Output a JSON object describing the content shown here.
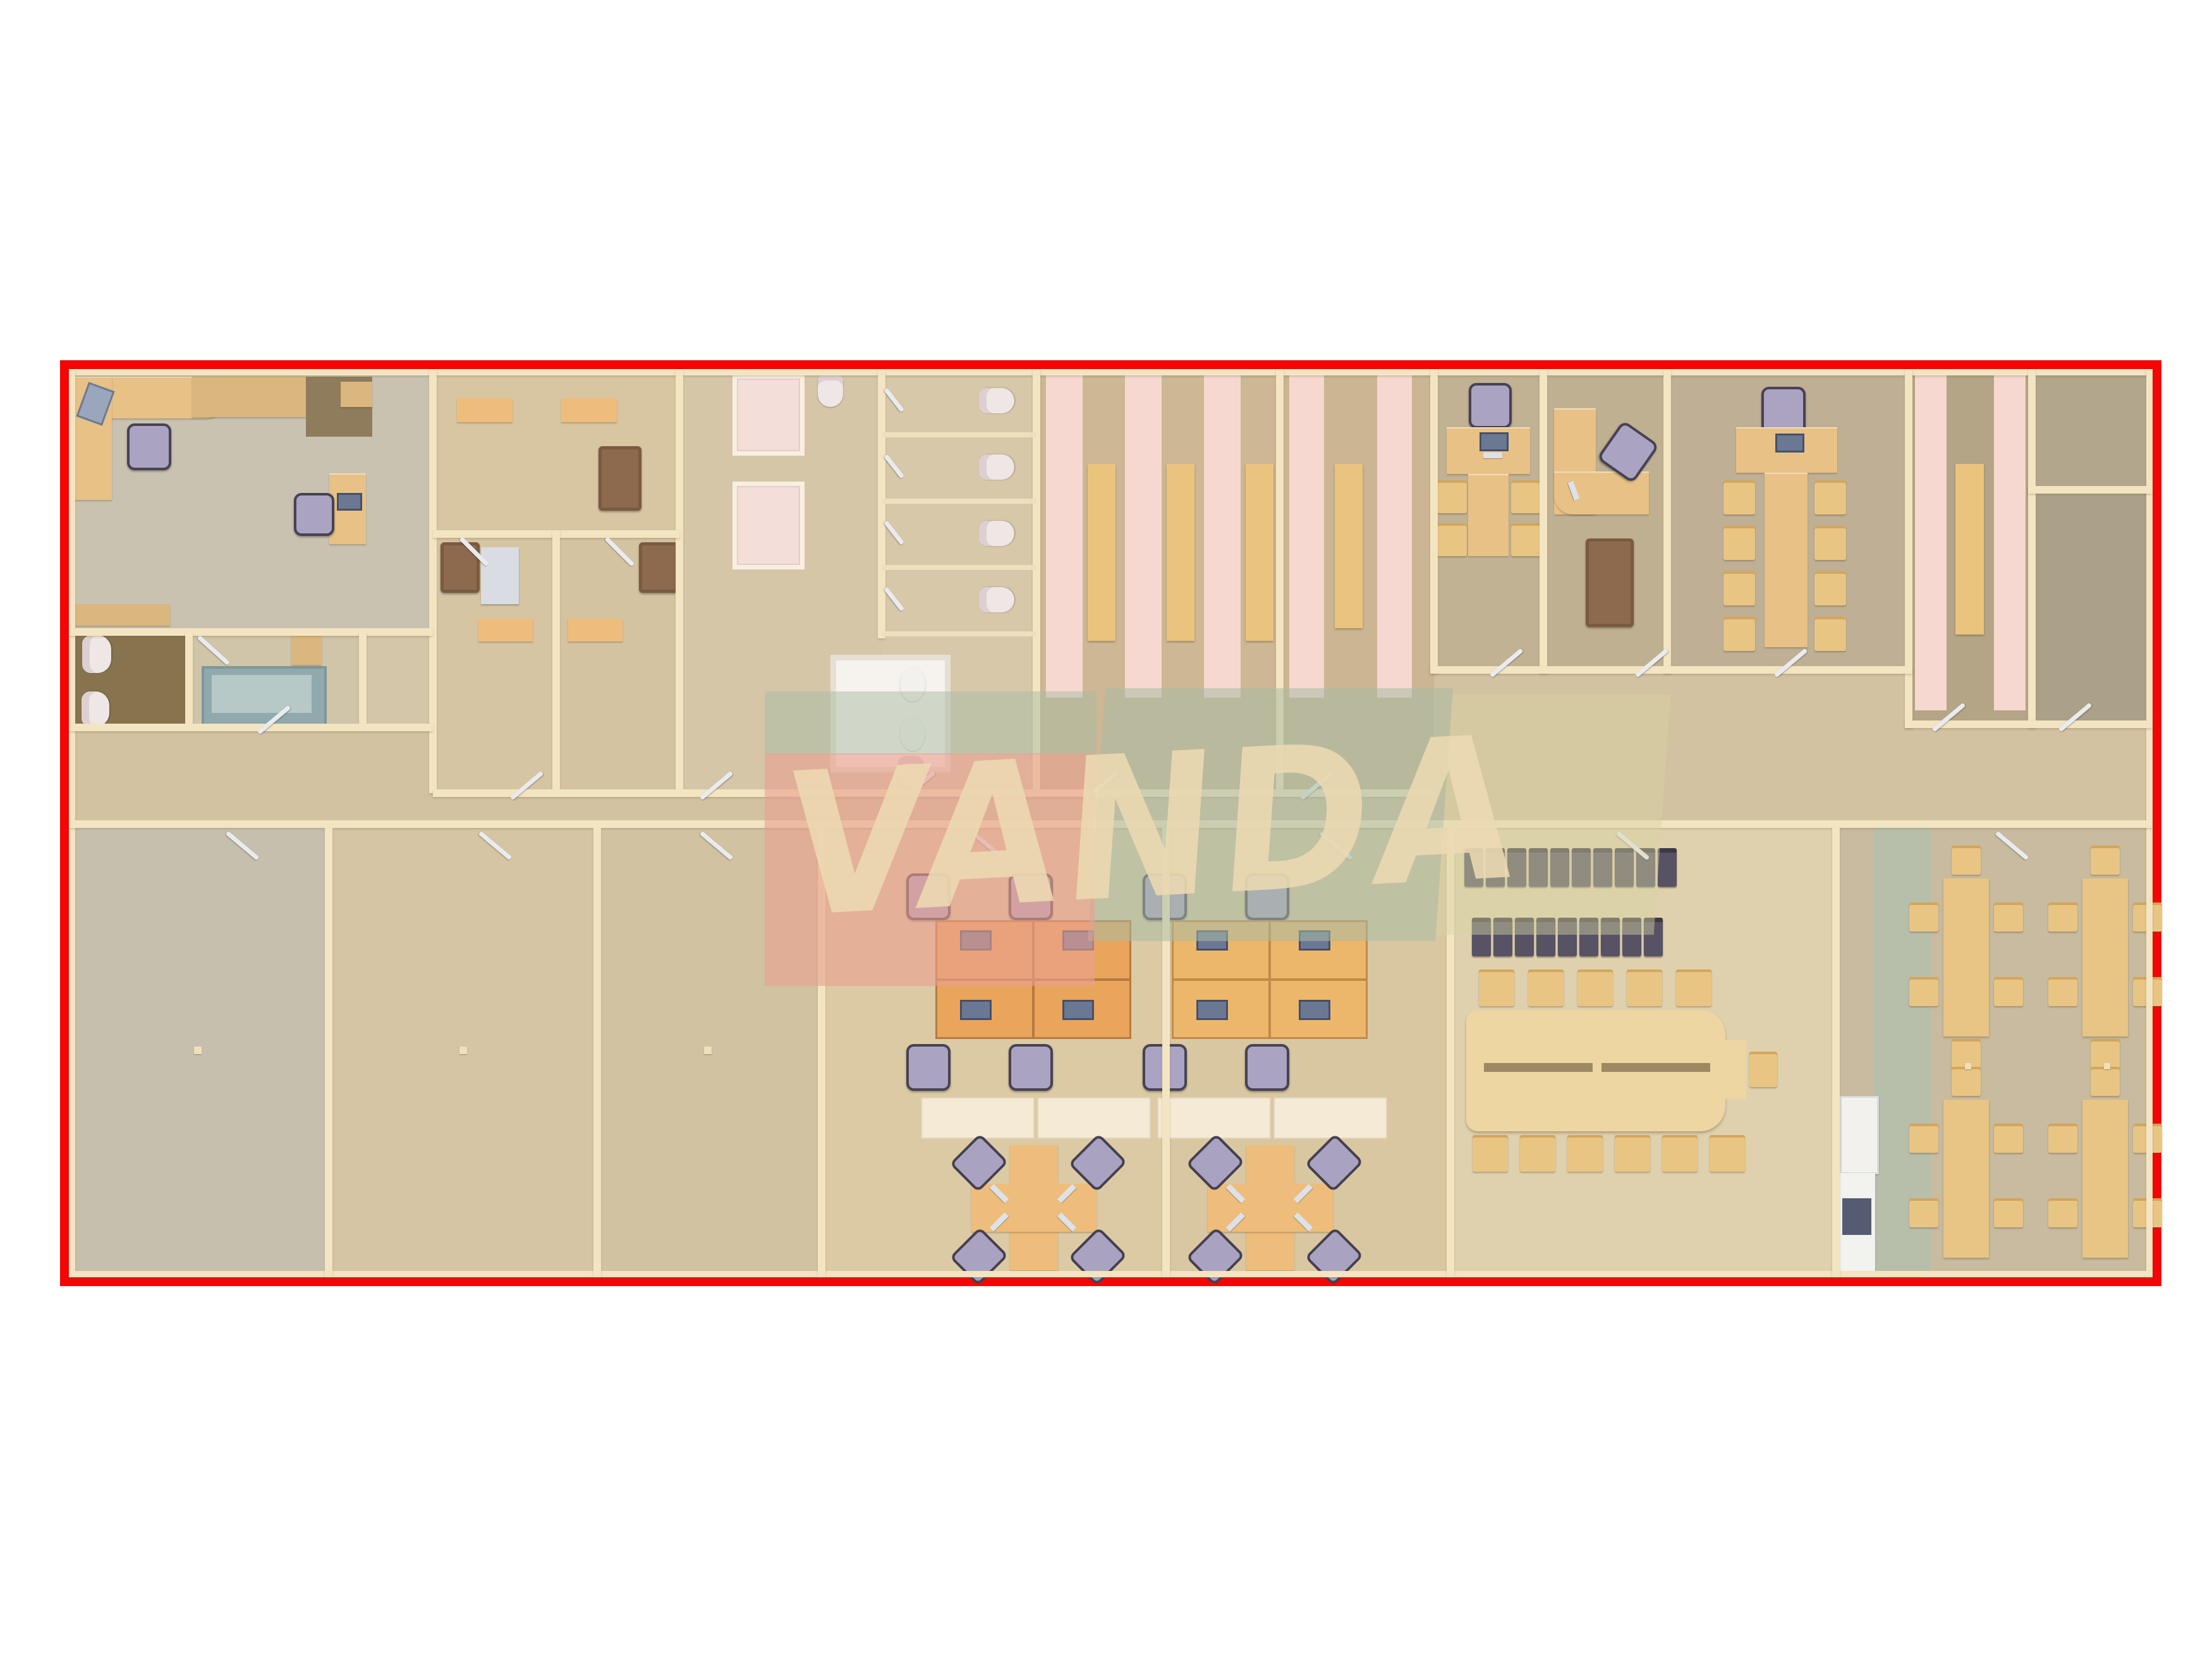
{
  "watermark": {
    "text": "VANDA",
    "letter_color": "#ecd9b2",
    "block_colors": {
      "salmon": "#e89f90",
      "sage_green": "#a9bba4",
      "pale_yellow": "#d8d2a2"
    }
  },
  "frame": {
    "border_color": "#f40606",
    "page_background": "#ffffff"
  },
  "palette": {
    "floor_light_wood": "#dccaa5",
    "floor_tan": "#cdb794",
    "floor_gray_beige": "#cac2b1",
    "floor_gray_right": "#c2b294",
    "floor_dark_wc": "#87744f",
    "wall_cream": "#f3e5c1",
    "stripe_pink": "#f6d8d0",
    "desk_wood": "#e7c186",
    "desk_orange": "#e9a55b",
    "chair_lilac": "#aaa3c2",
    "chair_dark": "#575264",
    "sofa_brown": "#8d6a4e",
    "fixture_white": "#f2f1ed",
    "bench_wood": "#eac47e",
    "table_teal": "#8fa9ad",
    "door_leaf": "#e9ebee"
  },
  "floor_plan": {
    "type": "office-building-floor-plan",
    "view": "top-down 3d render",
    "rooms": [
      {
        "name": "reception-office",
        "furniture": [
          "l-shaped-desk",
          "office-chair",
          "printer",
          "wardrobe",
          "closet",
          "side-desk-with-monitor",
          "office-chair",
          "low-cabinet"
        ]
      },
      {
        "name": "wc-room",
        "furniture": [
          "toilet",
          "bidet"
        ]
      },
      {
        "name": "utility-room",
        "furniture": [
          "teal-table",
          "wall-shelf"
        ]
      },
      {
        "name": "storage-room",
        "furniture": []
      },
      {
        "name": "lounge-meeting-room",
        "furniture": [
          "table",
          "table",
          "sofa"
        ]
      },
      {
        "name": "small-office-1",
        "furniture": [
          "armchair",
          "desk",
          "side-table"
        ]
      },
      {
        "name": "small-office-2",
        "furniture": [
          "armchair",
          "desk"
        ]
      },
      {
        "name": "shower-room",
        "furniture": [
          "shower-stall",
          "shower-stall",
          "shower-tray",
          "toilet"
        ]
      },
      {
        "name": "wc-stall-block",
        "furniture": [
          "toilet",
          "toilet",
          "toilet",
          "toilet",
          "basin",
          "basin",
          "toilet"
        ]
      },
      {
        "name": "locker-hall-1",
        "furniture": [
          "pink-mat",
          "pink-mat",
          "pink-mat",
          "bench",
          "bench",
          "bench"
        ]
      },
      {
        "name": "locker-hall-2",
        "furniture": [
          "pink-mat",
          "pink-mat",
          "bench"
        ]
      },
      {
        "name": "executive-office-1",
        "furniture": [
          "t-shaped-desk",
          "office-chair",
          "monitor",
          "side-chair",
          "side-chair",
          "side-chair",
          "side-chair"
        ]
      },
      {
        "name": "executive-office-2",
        "furniture": [
          "l-shaped-desk",
          "office-chair",
          "keyboard",
          "sofa"
        ]
      },
      {
        "name": "conference-office",
        "furniture": [
          "t-shaped-conference-table",
          "office-chair",
          "monitor",
          "side-chair",
          "side-chair",
          "side-chair",
          "side-chair",
          "side-chair",
          "side-chair",
          "side-chair",
          "side-chair"
        ]
      },
      {
        "name": "locker-hall-3",
        "furniture": [
          "pink-mat",
          "pink-mat",
          "bench"
        ]
      },
      {
        "name": "storeroom-upper",
        "furniture": []
      },
      {
        "name": "storeroom-lower",
        "furniture": []
      },
      {
        "name": "corridor",
        "furniture": [
          "doors"
        ]
      },
      {
        "name": "empty-hall-1",
        "furniture": [
          "column"
        ]
      },
      {
        "name": "empty-hall-2",
        "furniture": [
          "column"
        ]
      },
      {
        "name": "empty-hall-3",
        "furniture": [
          "column"
        ]
      },
      {
        "name": "open-office-1",
        "furniture": [
          "workstation-cluster-2x2",
          "monitor",
          "monitor",
          "monitor",
          "monitor",
          "office-chair",
          "office-chair",
          "office-chair",
          "office-chair",
          "credenza",
          "pinwheel-desk-cluster",
          "office-chair",
          "office-chair",
          "office-chair",
          "office-chair"
        ]
      },
      {
        "name": "open-office-2",
        "furniture": [
          "workstation-cluster-2x2",
          "monitor",
          "monitor",
          "monitor",
          "monitor",
          "office-chair",
          "office-chair",
          "office-chair",
          "office-chair",
          "credenza",
          "pinwheel-desk-cluster",
          "office-chair",
          "office-chair",
          "office-chair",
          "office-chair"
        ]
      },
      {
        "name": "training-room",
        "furniture": [
          "dark-chair-row-of-10",
          "dark-chair-row-of-9",
          "large-conference-table",
          "chair",
          "chair",
          "chair",
          "chair",
          "chair",
          "chair",
          "chair",
          "chair",
          "chair",
          "chair",
          "chair",
          "end-chair"
        ]
      },
      {
        "name": "kitchenette",
        "furniture": [
          "fridge",
          "counter",
          "appliance"
        ]
      },
      {
        "name": "cafeteria",
        "furniture": [
          "dining-table-6-chairs",
          "dining-table-6-chairs",
          "dining-table-6-chairs",
          "dining-table-6-chairs",
          "column",
          "column"
        ]
      }
    ]
  }
}
